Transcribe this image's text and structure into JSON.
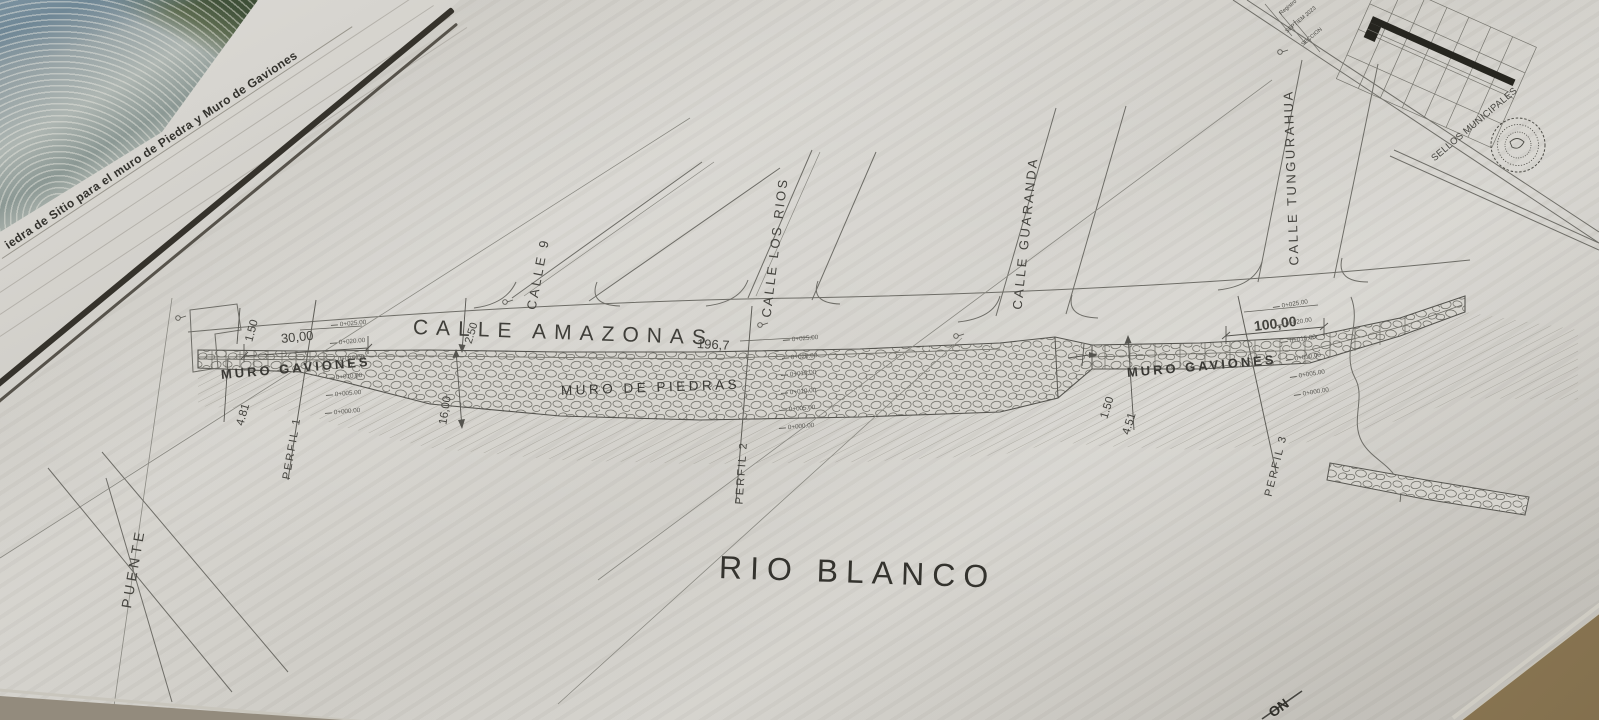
{
  "sheet": {
    "photo_caption": "iedra de Sitio para el muro de Piedra y Muro de Gaviones",
    "main_street": {
      "name": "CALLE AMAZONAS",
      "length_label": "196,7"
    },
    "cross_streets": [
      "CALLE 9",
      "CALLE LOS RIOS",
      "CALLE GUARANDA",
      "CALLE TUNGURAHUA"
    ],
    "walls": [
      "MURO GAVIONES",
      "MURO DE PIEDRAS",
      "MURO GAVIONES"
    ],
    "river_name": "RIO BLANCO",
    "bridge_label": "PUENTE",
    "profiles": [
      "PERFIL 1",
      "PERFIL 2",
      "PERFIL 3"
    ],
    "dimension_values": [
      "1.50",
      "30,00",
      "4.81",
      "2.50",
      "16,00",
      "100,00",
      "1.50",
      "4.51"
    ],
    "title_block": {
      "sellos_label": "SELLOS MUNICIPALES",
      "registro_label": "Registro",
      "date_label": "SEPTIEM 2023",
      "section_label": "SECCION"
    },
    "bottom_corner_fragment": "ON"
  },
  "annotations": [
    {
      "name": "photo-caption",
      "text": "iedra de Sitio para el muro de Piedra y Muro de Gaviones",
      "x": 6,
      "y": 240,
      "rot": -33.5,
      "size": 12,
      "ls": 0.4,
      "w": 700,
      "color": "#33322d"
    },
    {
      "name": "street-label-calle-9",
      "text": "CALLE 9",
      "x": 531,
      "y": 303,
      "rot": -79,
      "size": 13,
      "ls": 3,
      "w": 500
    },
    {
      "name": "street-label-calle-los-rios",
      "text": "CALLE LOS RIOS",
      "x": 766,
      "y": 311,
      "rot": -83,
      "size": 13,
      "ls": 2.5,
      "w": 500
    },
    {
      "name": "street-label-calle-guaranda",
      "text": "CALLE GUARANDA",
      "x": 1017,
      "y": 303,
      "rot": -84,
      "size": 13,
      "ls": 2.5,
      "w": 500
    },
    {
      "name": "street-label-calle-tungurahua",
      "text": "CALLE TUNGURAHUA",
      "x": 1294,
      "y": 259,
      "rot": -92,
      "size": 13,
      "ls": 2.5,
      "w": 500
    },
    {
      "name": "main-street-label",
      "text": "CALLE AMAZONAS",
      "x": 413,
      "y": 317,
      "rot": 2,
      "size": 21,
      "ls": 8,
      "w": 500,
      "color": "#3f3e39"
    },
    {
      "name": "main-street-length",
      "text": "196,7",
      "x": 697,
      "y": 337,
      "rot": 3,
      "size": 13,
      "w": 500
    },
    {
      "name": "wall-label-muro-gaviones-left",
      "text": "MURO GAVIONES",
      "x": 221,
      "y": 368,
      "rot": -5,
      "size": 13,
      "ls": 3,
      "w": 600,
      "color": "#3a3935"
    },
    {
      "name": "wall-label-muro-de-piedras",
      "text": "MURO DE PIEDRAS",
      "x": 561,
      "y": 384,
      "rot": -2,
      "size": 13.5,
      "ls": 3.5,
      "w": 500,
      "color": "#3a3935"
    },
    {
      "name": "wall-label-muro-gaviones-right",
      "text": "MURO GAVIONES",
      "x": 1127,
      "y": 366,
      "rot": -5,
      "size": 13,
      "ls": 3,
      "w": 600,
      "color": "#3a3935"
    },
    {
      "name": "river-label",
      "text": "RIO BLANCO",
      "x": 719,
      "y": 551,
      "rot": 2,
      "size": 32,
      "ls": 8,
      "w": 500,
      "color": "#34332e"
    },
    {
      "name": "bridge-label",
      "text": "PUENTE",
      "x": 126,
      "y": 601,
      "rot": -80,
      "size": 14,
      "ls": 4,
      "w": 500
    },
    {
      "name": "profile-label-perfil-1",
      "text": "PERFIL 1",
      "x": 287,
      "y": 474,
      "rot": -80,
      "size": 11,
      "ls": 2,
      "w": 500
    },
    {
      "name": "profile-label-perfil-2",
      "text": "PERFIL 2",
      "x": 740,
      "y": 499,
      "rot": -86,
      "size": 11,
      "ls": 2,
      "w": 500
    },
    {
      "name": "profile-label-perfil-3",
      "text": "PERFIL 3",
      "x": 1269,
      "y": 491,
      "rot": -76,
      "size": 11,
      "ls": 2,
      "w": 500
    },
    {
      "name": "dim-left-1-50",
      "text": "1.50",
      "x": 250,
      "y": 336,
      "rot": -75,
      "size": 11.5,
      "w": 500
    },
    {
      "name": "dim-30-00",
      "text": "30,00",
      "x": 281,
      "y": 332,
      "rot": -6,
      "size": 13,
      "w": 500
    },
    {
      "name": "dim-4-81",
      "text": "4.81",
      "x": 241,
      "y": 420,
      "rot": -74,
      "size": 11.5,
      "w": 500
    },
    {
      "name": "dim-2-50",
      "text": "2.50",
      "x": 469,
      "y": 338,
      "rot": -73,
      "size": 11,
      "w": 500
    },
    {
      "name": "dim-16-00",
      "text": "16,00",
      "x": 444,
      "y": 419,
      "rot": -81,
      "size": 11.5,
      "w": 500
    },
    {
      "name": "dim-100-00",
      "text": "100,00",
      "x": 1254,
      "y": 319,
      "rot": -7,
      "size": 14,
      "w": 600
    },
    {
      "name": "dim-right-1-50",
      "text": "1.50",
      "x": 1105,
      "y": 413,
      "rot": -73,
      "size": 11.5,
      "w": 500
    },
    {
      "name": "dim-4-51",
      "text": "4.51",
      "x": 1127,
      "y": 429,
      "rot": -73,
      "size": 11.5,
      "w": 500
    },
    {
      "name": "seal-strip-title",
      "text": "SELLOS MUNICIPALES",
      "x": 1433,
      "y": 155,
      "rot": -40,
      "size": 9.5,
      "ls": 0.3,
      "w": 500
    },
    {
      "name": "titleblock-registro",
      "text": "Registro",
      "x": 1281,
      "y": 12,
      "rot": -40,
      "size": 5.5,
      "w": 400
    },
    {
      "name": "titleblock-fecha",
      "text": "SEPTIEM 2023",
      "x": 1287,
      "y": 30,
      "rot": -40,
      "size": 5.5,
      "w": 400
    },
    {
      "name": "titleblock-seccion",
      "text": "SECCION",
      "x": 1303,
      "y": 43,
      "rot": -40,
      "size": 5.5,
      "w": 400
    },
    {
      "name": "corner-text-fragment",
      "text": "ON",
      "x": 1270,
      "y": 707,
      "rot": -36,
      "size": 14,
      "w": 700,
      "color": "#302f2a"
    }
  ],
  "stations": {
    "labels": [
      "0+025.00",
      "0+020.00",
      "0+015.00",
      "0+010.00",
      "0+005.00",
      "0+000.00"
    ],
    "groups": [
      {
        "name": "stations-perfil-1",
        "x": 331,
        "y": 323,
        "dx": -1.2,
        "dy": 17.6,
        "rot": -5
      },
      {
        "name": "stations-perfil-2",
        "x": 783,
        "y": 338,
        "dx": -0.8,
        "dy": 17.6,
        "rot": -5
      },
      {
        "name": "stations-perfil-3",
        "x": 1273,
        "y": 305,
        "dx": 4.2,
        "dy": 17.6,
        "rot": -9
      }
    ]
  },
  "colors": {
    "paper": "#d2d0ca",
    "ink": "#55544f",
    "text": "#45443f",
    "shadow_band": "#35322b",
    "table_surface": "#a28a60"
  }
}
